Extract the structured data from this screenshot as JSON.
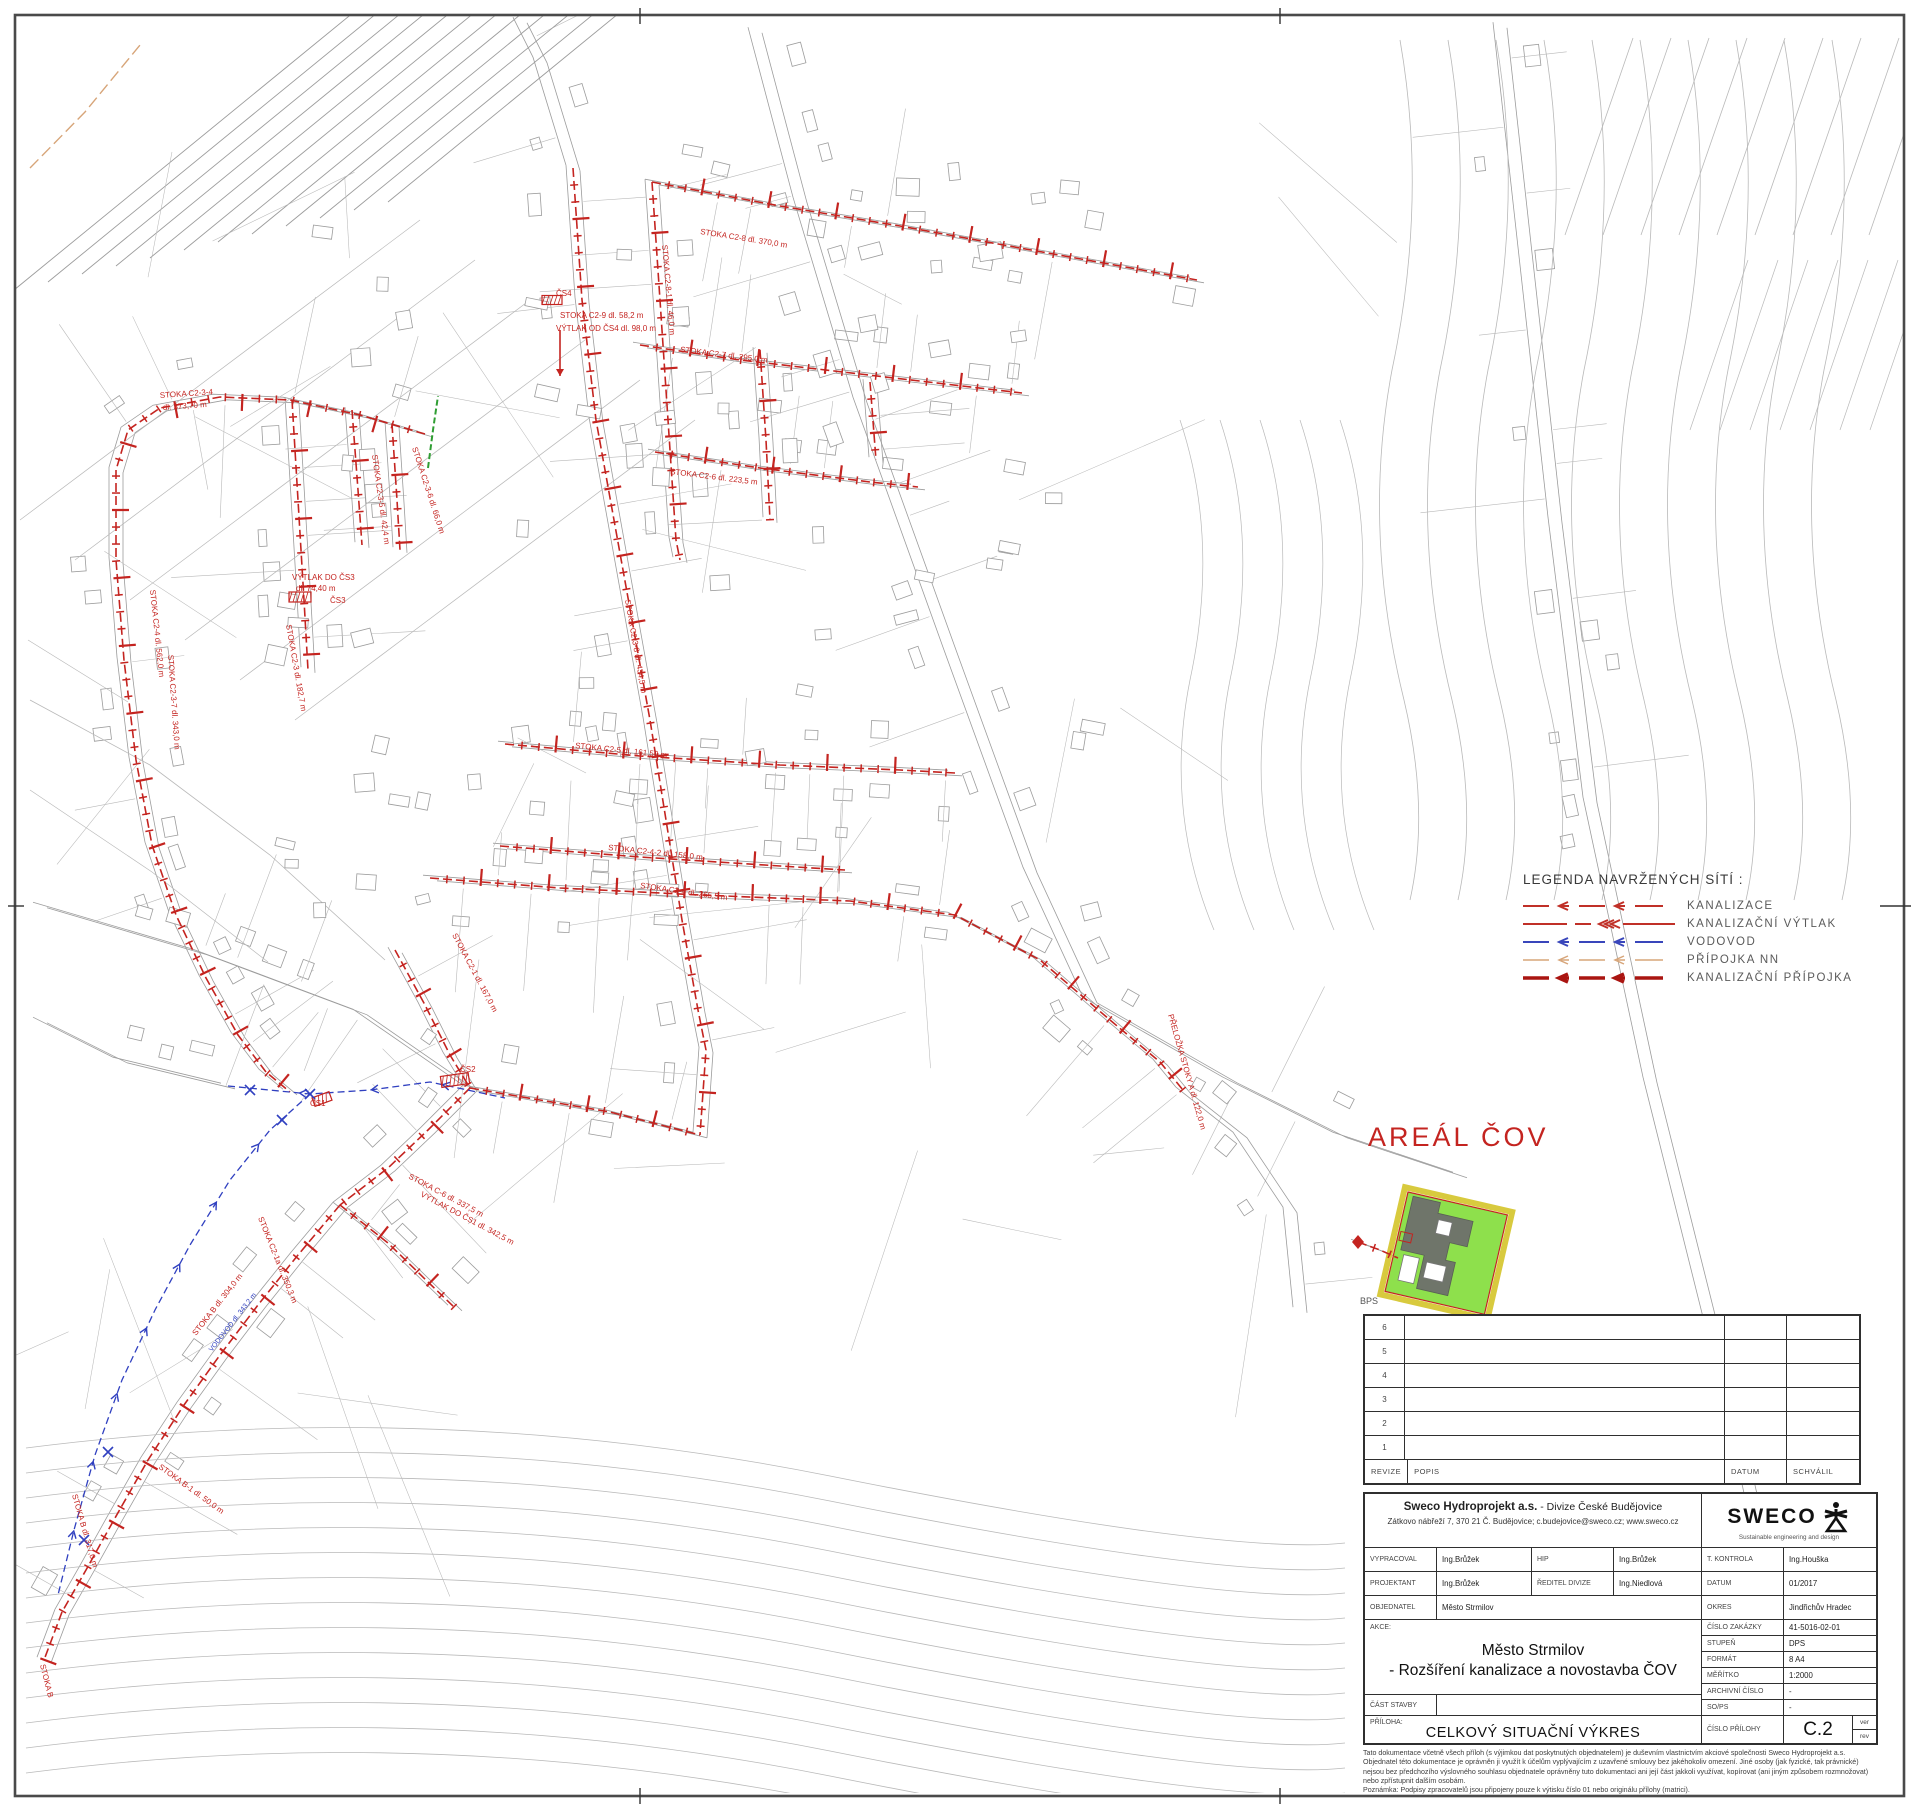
{
  "legend": {
    "title": "LEGENDA NAVRŽENÝCH SÍTÍ :",
    "items": [
      {
        "name": "kanalizace",
        "label": "KANALIZACE",
        "color": "#c03028",
        "width": 2,
        "style": "arrow-dash"
      },
      {
        "name": "kanalizacni-vytlak",
        "label": "KANALIZAČNÍ  VÝTLAK",
        "color": "#c03028",
        "width": 2,
        "style": "triple-arrow"
      },
      {
        "name": "vodovod",
        "label": "VODOVOD",
        "color": "#3946bb",
        "width": 2,
        "style": "arrow-dash"
      },
      {
        "name": "pripojka-nn",
        "label": "PŘÍPOJKA  NN",
        "color": "#d7a579",
        "width": 1.5,
        "style": "arrow-dash"
      },
      {
        "name": "kanalizacni-pripojka",
        "label": "KANALIZAČNÍ  PŘÍPOJKA",
        "color": "#aa1511",
        "width": 3.6,
        "style": "bold-arrow"
      }
    ]
  },
  "map": {
    "areal_cov_label": "AREÁL ČOV",
    "bps_label": "BPS",
    "styles": {
      "k": {
        "color": "#c42420",
        "w": 1.6,
        "dash": "9 4",
        "ticks": 17
      },
      "v": {
        "color": "#3040c0",
        "w": 1.3,
        "dash": "7 4",
        "chev": 72
      },
      "n": {
        "color": "#d7a579",
        "w": 1.4,
        "dash": "12 5"
      },
      "g": {
        "color": "#2f9e33",
        "w": 2,
        "dash": "6 3"
      }
    },
    "lines": [
      {
        "t": "k",
        "pts": [
          [
            652,
            182
          ],
          [
            780,
            206
          ],
          [
            900,
            226
          ],
          [
            1020,
            248
          ],
          [
            1120,
            266
          ],
          [
            1197,
            280
          ]
        ]
      },
      {
        "t": "k",
        "pts": [
          [
            640,
            345
          ],
          [
            740,
            360
          ],
          [
            860,
            374
          ],
          [
            1022,
            393
          ]
        ]
      },
      {
        "t": "k",
        "pts": [
          [
            655,
            452
          ],
          [
            760,
            468
          ],
          [
            870,
            482
          ],
          [
            918,
            487
          ]
        ]
      },
      {
        "t": "k",
        "pts": [
          [
            652,
            182
          ],
          [
            660,
            300
          ],
          [
            668,
            420
          ],
          [
            676,
            540
          ],
          [
            680,
            560
          ]
        ]
      },
      {
        "t": "k",
        "pts": [
          [
            573,
            168
          ],
          [
            582,
            300
          ],
          [
            596,
            420
          ],
          [
            614,
            520
          ],
          [
            632,
            620
          ],
          [
            650,
            720
          ],
          [
            666,
            820
          ],
          [
            682,
            920
          ],
          [
            698,
            1010
          ],
          [
            706,
            1050
          ],
          [
            700,
            1135
          ]
        ]
      },
      {
        "t": "k",
        "pts": [
          [
            425,
            434
          ],
          [
            360,
            415
          ],
          [
            290,
            400
          ],
          [
            220,
            397
          ],
          [
            160,
            408
          ],
          [
            128,
            430
          ],
          [
            116,
            470
          ],
          [
            116,
            560
          ],
          [
            124,
            660
          ],
          [
            136,
            760
          ],
          [
            152,
            845
          ],
          [
            176,
            915
          ],
          [
            206,
            978
          ],
          [
            238,
            1035
          ],
          [
            266,
            1072
          ],
          [
            290,
            1092
          ]
        ]
      },
      {
        "t": "k",
        "pts": [
          [
            292,
            400
          ],
          [
            298,
            500
          ],
          [
            304,
            600
          ],
          [
            308,
            670
          ]
        ]
      },
      {
        "t": "k",
        "pts": [
          [
            352,
            410
          ],
          [
            358,
            490
          ],
          [
            362,
            545
          ]
        ]
      },
      {
        "t": "k",
        "pts": [
          [
            392,
            424
          ],
          [
            397,
            500
          ],
          [
            400,
            550
          ]
        ]
      },
      {
        "t": "k",
        "pts": [
          [
            505,
            744
          ],
          [
            640,
            756
          ],
          [
            780,
            765
          ],
          [
            900,
            770
          ],
          [
            955,
            773
          ]
        ]
      },
      {
        "t": "k",
        "pts": [
          [
            500,
            846
          ],
          [
            640,
            857
          ],
          [
            780,
            866
          ],
          [
            845,
            870
          ]
        ]
      },
      {
        "t": "k",
        "pts": [
          [
            430,
            878
          ],
          [
            560,
            888
          ],
          [
            700,
            895
          ],
          [
            850,
            901
          ],
          [
            955,
            915
          ],
          [
            1040,
            960
          ],
          [
            1110,
            1020
          ],
          [
            1160,
            1062
          ],
          [
            1183,
            1090
          ]
        ]
      },
      {
        "t": "k",
        "pts": [
          [
            395,
            950
          ],
          [
            425,
            1005
          ],
          [
            450,
            1055
          ],
          [
            470,
            1088
          ]
        ]
      },
      {
        "t": "k",
        "pts": [
          [
            470,
            1088
          ],
          [
            540,
            1100
          ],
          [
            610,
            1112
          ],
          [
            700,
            1135
          ]
        ]
      },
      {
        "t": "k",
        "pts": [
          [
            340,
            1205
          ],
          [
            298,
            1255
          ],
          [
            258,
            1305
          ],
          [
            220,
            1355
          ],
          [
            184,
            1405
          ],
          [
            148,
            1460
          ],
          [
            115,
            1518
          ],
          [
            86,
            1570
          ],
          [
            62,
            1612
          ]
        ]
      },
      {
        "t": "k",
        "pts": [
          [
            340,
            1205
          ],
          [
            388,
            1243
          ],
          [
            428,
            1282
          ],
          [
            455,
            1308
          ]
        ]
      },
      {
        "t": "k",
        "pts": [
          [
            470,
            1088
          ],
          [
            428,
            1130
          ],
          [
            388,
            1168
          ],
          [
            340,
            1205
          ]
        ]
      },
      {
        "t": "k",
        "pts": [
          [
            760,
            350
          ],
          [
            766,
            440
          ],
          [
            770,
            520
          ]
        ]
      },
      {
        "t": "k",
        "pts": [
          [
            870,
            382
          ],
          [
            876,
            460
          ]
        ]
      },
      {
        "t": "k",
        "pts": [
          [
            62,
            1612
          ],
          [
            44,
            1660
          ]
        ]
      },
      {
        "t": "k",
        "pts": [
          [
            1358,
            1242
          ],
          [
            1380,
            1250
          ],
          [
            1398,
            1258
          ]
        ]
      },
      {
        "t": "v",
        "pts": [
          [
            228,
            1086
          ],
          [
            310,
            1094
          ],
          [
            370,
            1090
          ],
          [
            430,
            1082
          ],
          [
            505,
            1098
          ]
        ]
      },
      {
        "t": "v",
        "pts": [
          [
            310,
            1094
          ],
          [
            270,
            1130
          ],
          [
            230,
            1180
          ],
          [
            190,
            1245
          ],
          [
            155,
            1310
          ],
          [
            122,
            1380
          ],
          [
            95,
            1455
          ],
          [
            74,
            1530
          ],
          [
            58,
            1595
          ]
        ]
      },
      {
        "t": "n",
        "pts": [
          [
            30,
            168
          ],
          [
            85,
            112
          ],
          [
            140,
            45
          ]
        ]
      },
      {
        "t": "g",
        "pts": [
          [
            428,
            468
          ],
          [
            433,
            430
          ],
          [
            438,
            396
          ]
        ]
      }
    ],
    "marks": [
      {
        "type": "diamond",
        "x": 1358,
        "y": 1242
      },
      {
        "type": "hatch",
        "x": 455,
        "y": 1080,
        "w": 28,
        "h": 11,
        "rot": -8
      },
      {
        "type": "hatch",
        "x": 300,
        "y": 597,
        "w": 22,
        "h": 10,
        "rot": 0
      },
      {
        "type": "hatch",
        "x": 552,
        "y": 300,
        "w": 20,
        "h": 9,
        "rot": 0
      },
      {
        "type": "hatch",
        "x": 322,
        "y": 1099,
        "w": 18,
        "h": 9,
        "rot": -20
      },
      {
        "type": "arrow",
        "x1": 560,
        "y1": 330,
        "x2": 560,
        "y2": 376
      },
      {
        "type": "cross",
        "x": 310,
        "y": 1094
      },
      {
        "type": "cross",
        "x": 282,
        "y": 1120
      },
      {
        "type": "cross",
        "x": 108,
        "y": 1452
      },
      {
        "type": "cross",
        "x": 84,
        "y": 1540
      },
      {
        "type": "cross",
        "x": 250,
        "y": 1090
      }
    ],
    "labels": [
      [
        "STOKA C2-8 dl. 370,0 m",
        700,
        234,
        9
      ],
      [
        "STOKA C2-8-1 dl. 46,0 m",
        662,
        245,
        85
      ],
      [
        "STOKA C2-7 dl. 295,0 m",
        680,
        352,
        7
      ],
      [
        "STOKA C2-6 dl. 223,5 m",
        670,
        474,
        7
      ],
      [
        "STOKA C2-3-4",
        160,
        398,
        -4
      ],
      [
        "dl. 373,70 m",
        163,
        410,
        -4
      ],
      [
        "STOKA C2-3-5 dl. 42,4 m",
        372,
        455,
        82
      ],
      [
        "STOKA C2-3-6 dl. 66,0 m",
        412,
        448,
        72
      ],
      [
        "STOKA C2-4 dl. 562,0 m",
        150,
        590,
        84
      ],
      [
        "STOKA C2-3-7 dl. 343,0 m",
        168,
        655,
        86
      ],
      [
        "VÝTLAK DO ČS3",
        292,
        580,
        0
      ],
      [
        "dl. 74,40 m",
        296,
        591,
        0
      ],
      [
        "ČS3",
        330,
        603,
        0
      ],
      [
        "STOKA C2-3 dl. 182,7 m",
        286,
        625,
        80
      ],
      [
        "ČS4",
        556,
        296,
        0
      ],
      [
        "STOKA C2-9 dl. 58,2 m",
        560,
        318,
        0
      ],
      [
        "VÝTLAK OD ČS4 dl. 98,0 m",
        556,
        331,
        0
      ],
      [
        "STOKA C2-3-8 dl. 434,5 m",
        625,
        600,
        80
      ],
      [
        "STOKA C2-5 dl. 161,50 m",
        575,
        748,
        6
      ],
      [
        "STOKA C2-4-2 dl. 158,0 m",
        608,
        850,
        6
      ],
      [
        "STOKA C2-4 dl. 265,5 m",
        640,
        888,
        8
      ],
      [
        "STOKA C2-1 dl. 167,0 m",
        452,
        935,
        62
      ],
      [
        "STOKA C2-1a dl. 350,3 m",
        258,
        1218,
        68
      ],
      [
        "STOKA C-6 dl. 337,5 m",
        408,
        1178,
        28
      ],
      [
        "VÝTLAK DO ČS1 dl. 342,5 m",
        420,
        1196,
        28
      ],
      [
        "ČS1",
        310,
        1106,
        0
      ],
      [
        "ČS2",
        460,
        1072,
        0
      ],
      [
        "STOKA B dl. 317,0 m",
        72,
        1495,
        74
      ],
      [
        "STOKA B-1 dl. 50,0 m",
        158,
        1468,
        36
      ],
      [
        "STOKA B dl. 304,0 m",
        196,
        1336,
        -52
      ],
      [
        "VODOVOD dl. 343,2 m",
        212,
        1352,
        -52,
        7,
        "#3040c0"
      ],
      [
        "PŘELOŽKA STOKY A dl. 122,0 m",
        1168,
        1015,
        74
      ],
      [
        "STOKA B",
        40,
        1665,
        76
      ]
    ]
  },
  "revision_table": {
    "rows": [
      "6",
      "5",
      "4",
      "3",
      "2",
      "1"
    ],
    "headers": [
      "REVIZE",
      "POPIS",
      "DATUM",
      "SCHVÁLIL"
    ]
  },
  "title_block": {
    "company_bold": "Sweco Hydroprojekt a.s.",
    "company_rest": " - Divize České Budějovice",
    "address": "Zátkovo nábřeží 7, 370 21 Č. Budějovice; c.budejovice@sweco.cz; www.sweco.cz",
    "logo_text": "SWECO",
    "logo_tagline": "Sustainable engineering and design",
    "vypracoval_label": "VYPRACOVAL",
    "vypracoval": "Ing.Brůžek",
    "hip_label": "HIP",
    "hip": "Ing.Brůžek",
    "t_kontrola_label": "T. KONTROLA",
    "t_kontrola": "Ing.Houška",
    "projektant_label": "PROJEKTANT",
    "projektant": "Ing.Brůžek",
    "reditel_label": "ŘEDITEL DIVIZE",
    "reditel": "Ing.Niedlová",
    "datum_label": "DATUM",
    "datum": "01/2017",
    "objednatel_label": "OBJEDNATEL",
    "objednatel": "Město Strmilov",
    "okres_label": "OKRES",
    "okres": "Jindřichův Hradec",
    "akce_label": "AKCE:",
    "title_line1": "Město Strmilov",
    "title_line2": "- Rozšíření kanalizace a novostavba ČOV",
    "cislo_zakazky_label": "ČÍSLO ZAKÁZKY",
    "cislo_zakazky": "41-5016-02-01",
    "stupen_label": "STUPEŇ",
    "stupen": "DPS",
    "format_label": "FORMÁT",
    "format": "8 A4",
    "meritko_label": "MĚŘÍTKO",
    "meritko": "1:2000",
    "archivni_label": "ARCHIVNÍ ČÍSLO",
    "archivni": "-",
    "cast_stavby_label": "ČÁST STAVBY",
    "sops_label": "SO/PS",
    "sops": "-",
    "priloha_label": "PŘÍLOHA:",
    "priloha": "CELKOVÝ SITUAČNÍ VÝKRES",
    "cislo_prilohy_label": "ČÍSLO PŘÍLOHY",
    "cislo_prilohy": "C.2",
    "ver": "ver",
    "rev": "rev"
  },
  "disclaimer": [
    "Tato dokumentace včetně všech příloh (s výjimkou dat poskytnutých objednatelem) je duševním vlastnictvím akciové společnosti Sweco Hydroprojekt a.s.",
    "Objednatel této dokumentace je oprávněn ji využít k účelům vyplývajícím z uzavřené smlouvy bez jakéhokoliv omezení.  Jiné osoby (jak fyzické, tak právnické)",
    "nejsou bez předchozího výslovného souhlasu objednatele oprávněny tuto dokumentaci ani její část jakkoli využívat, kopírovat (ani jiným způsobem rozmnožovat)",
    "nebo zpřístupnit dalším osobám.",
    "Poznámka: Podpisy zpracovatelů jsou připojeny pouze k výtisku číslo 01 nebo originálu přílohy (matrici)."
  ]
}
